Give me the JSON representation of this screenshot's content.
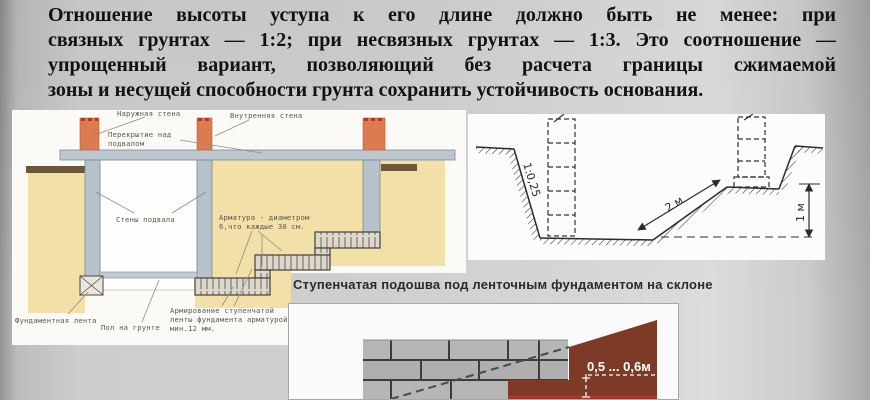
{
  "intro": {
    "lines": [
      "Отношение высоты уступа к его длине должно быть не менее: при",
      "связных грунтах — 1:2; при несвязных грунтах — 1:3. Это соотношение —",
      "упрощенный вариант, позволяющий без расчета границы сжимаемой",
      "зоны и несущей способности грунта сохранить устойчивость основания."
    ]
  },
  "basement_diagram": {
    "labels": {
      "outer_wall": "Наружная стена",
      "inner_wall": "Внутренняя стена",
      "ceiling_1": "Перекрытие над",
      "ceiling_2": "подвалом",
      "basement_walls": "Стены подвала",
      "rebar_1": "Арматура - диаметром",
      "rebar_2": "6,что каждые 30 см.",
      "strip_footing": "Фундаментная лента",
      "ground_floor": "Пол на грунте",
      "reinforcement_1": "Армирование ступенчатой",
      "reinforcement_2": "ленты фундамента арматурой",
      "reinforcement_3": "мин.12 мм."
    }
  },
  "trench_diagram": {
    "slope_ratio": "1:0,25",
    "slope_length": "2 м",
    "depth": "1 м"
  },
  "step_footing_diagram": {
    "title": "Ступенчатая подошва под ленточным фундаментом на склоне",
    "step_dimension": "0,5 ... 0,6м"
  },
  "colors": {
    "soil": "#f3dfa8",
    "topsoil": "#6e5638",
    "brick_wall": "#dd7a50",
    "concrete_wall": "#b5c1cb",
    "slope_soil": "#7d3a26",
    "red_line": "#b03a2a"
  }
}
